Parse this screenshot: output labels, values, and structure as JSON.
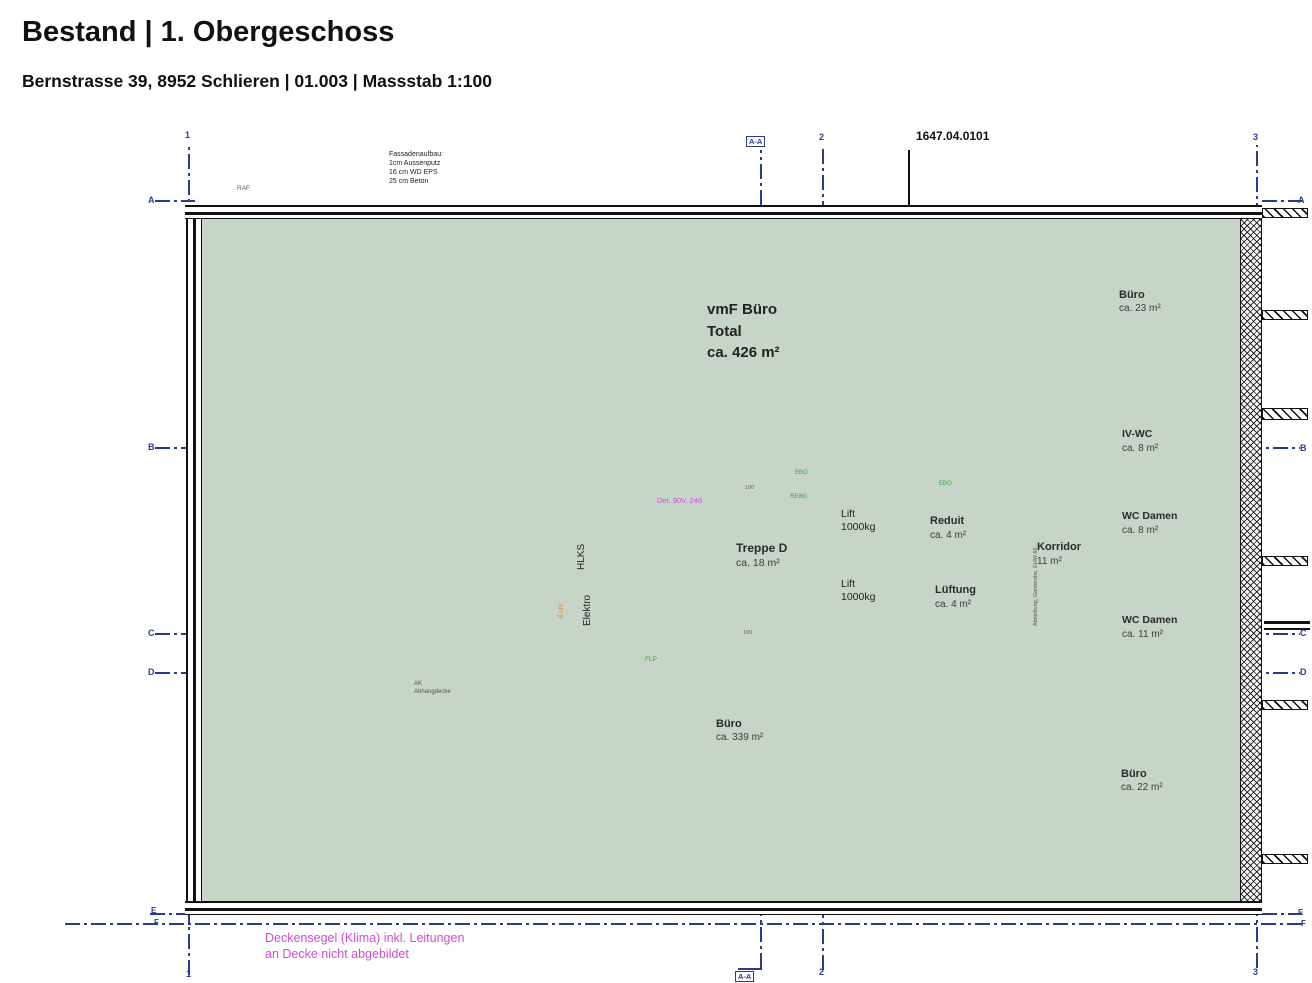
{
  "header": {
    "title": "Bestand | 1. Obergeschoss",
    "subtitle": "Bernstrasse 39, 8952 Schlieren | 01.003 | Massstab 1:100"
  },
  "annotations": {
    "drawing_number": "1647.04.0101",
    "facade_note": "Fassadenaufbau:\n1cm Aussenputz\n16 cm WD EPS\n25 cm Beton",
    "raf": "RAF",
    "ceiling_note": "Deckensegel (Klima) inkl. Leitungen\nan Decke nicht abgebildet",
    "ak_note": "AK\nAbhangdecke",
    "detail_tag": "Det. 90V. 246",
    "ebo": "EBO",
    "rei60": "REI60",
    "flp": "FLP",
    "door_width": "100",
    "wall_note": "Abstellung, Garderobe, EHW 60"
  },
  "rooms": {
    "vmf": {
      "name": "vmF Büro",
      "line2": "Total",
      "area": "ca. 426 m²"
    },
    "buero_tr": {
      "name": "Büro",
      "area": "ca. 23 m²"
    },
    "buero_main": {
      "name": "Büro",
      "area": "ca. 339 m²"
    },
    "buero_br": {
      "name": "Büro",
      "area": "ca. 22 m²"
    },
    "iv_wc": {
      "name": "IV-WC",
      "area": "ca. 8 m²"
    },
    "wc_damen_1": {
      "name": "WC Damen",
      "area": "ca. 8 m²"
    },
    "wc_damen_2": {
      "name": "WC Damen",
      "area": "ca. 11 m²"
    },
    "korridor": {
      "name": "Korridor",
      "area": "11 m²"
    },
    "treppe": {
      "name": "Treppe D",
      "area": "ca. 18 m²"
    },
    "reduit": {
      "name": "Reduit",
      "area": "ca. 4 m²"
    },
    "lueftung": {
      "name": "Lüftung",
      "area": "ca. 4 m²"
    },
    "hlks": "HLKS",
    "elektro": "Elektro",
    "euv": "E-UV",
    "lift1": {
      "name": "Lift",
      "capacity": "1000kg"
    },
    "lift2": {
      "name": "Lift",
      "capacity": "1000kg"
    }
  },
  "grid": {
    "h": [
      "A",
      "B",
      "C",
      "D",
      "E",
      "F"
    ],
    "v": [
      "1",
      "2",
      "3"
    ],
    "section": "A-A"
  },
  "colors": {
    "floor_green": "#c6d5c7",
    "core_gray": "#d9d9d9",
    "grid_blue": "#2b3a8f",
    "note_magenta": "#cf4ecf",
    "label_green": "#3f9e4f",
    "euv_orange": "#d57f3c",
    "sill_tan": "#c8b795"
  }
}
